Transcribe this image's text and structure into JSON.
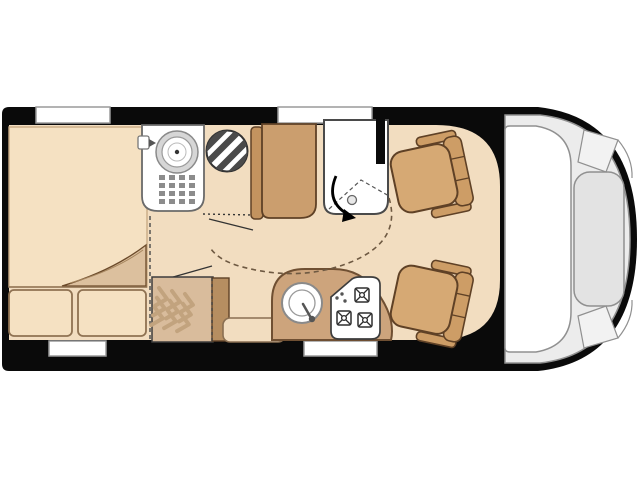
{
  "meta": {
    "title": "Motorhome floor plan",
    "view": "top-down",
    "orientation": "cab-at-right"
  },
  "colors": {
    "wall": "#0a0a0a",
    "floor": "#f2ddc0",
    "bed": "#f5e1c2",
    "fold": "#dcc09e",
    "bench": "#cb9e6e",
    "bench_back": "#c3935f",
    "kitchen": "#cda47c",
    "wardrobe": "#d9bc9c",
    "wardrobe_side": "#b68e61",
    "chevron": "#c2a37e",
    "seat": "#d6a974",
    "seat_dark": "#cd9d66",
    "outline_brown": "#5f4126",
    "cab": "#ececec",
    "hood": "#e3e3e3",
    "line_gray": "#909090",
    "drain": "#8c8c8c",
    "stripe": "#4a4a4a",
    "arc": "#6e5942"
  },
  "features": {
    "bed": {
      "label": "rear bed",
      "pillow_count": 2,
      "has_blanket_fold": true
    },
    "bathroom": {
      "label": "bathroom",
      "fixtures": [
        "washbasin",
        "faucet",
        "shower drain",
        "toilet"
      ]
    },
    "swivel_wall": {
      "label": "swivel bathroom wall",
      "has_rotation_arrow": true,
      "has_swing_arc": true
    },
    "bench": {
      "label": "bench seat"
    },
    "wardrobe": {
      "label": "wardrobe",
      "chevron_columns": 3
    },
    "cabinet": {
      "label": "low cabinet"
    },
    "kitchen": {
      "label": "kitchen block",
      "fixtures": [
        "round sink",
        "hob"
      ],
      "hob_burners": 3
    },
    "cab": {
      "label": "driver cab",
      "swivel_seats": 2,
      "elements": [
        "windshield",
        "hood"
      ]
    },
    "openings": {
      "top_windows": 2,
      "bottom_windows": 2
    }
  }
}
